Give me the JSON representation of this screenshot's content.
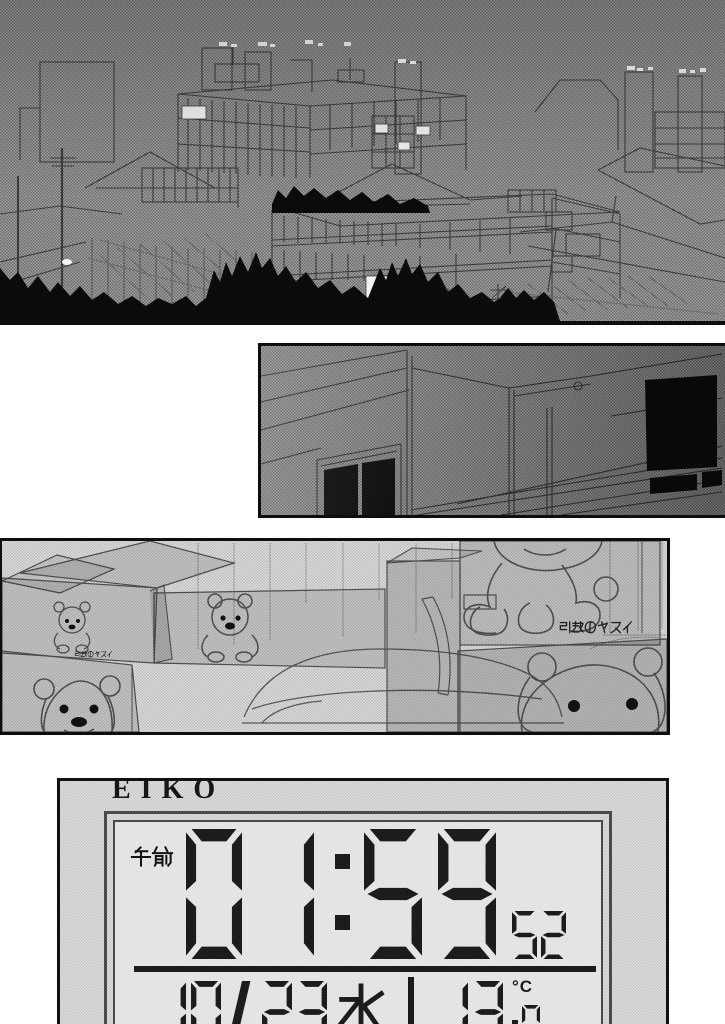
{
  "clock": {
    "brand": "EIKO",
    "am_label": "午前",
    "hours": "01",
    "minutes": "59",
    "seconds": "52",
    "month": "10",
    "date_separator": "/",
    "day": "23",
    "weekday": "水",
    "temperature": "13",
    "temperature_decimal": "0",
    "temperature_unit": "°C"
  },
  "moving_boxes": {
    "brand_label": "引越のヤスイ",
    "brand_label_small": "引越のヤスイ"
  },
  "colors": {
    "panel_border": "#0e0e0e",
    "lcd_segment": "#1c1c1c",
    "page_background": "#ffffff",
    "silhouette": "#0b0b0b",
    "lit_window": "#f2f2f2"
  }
}
